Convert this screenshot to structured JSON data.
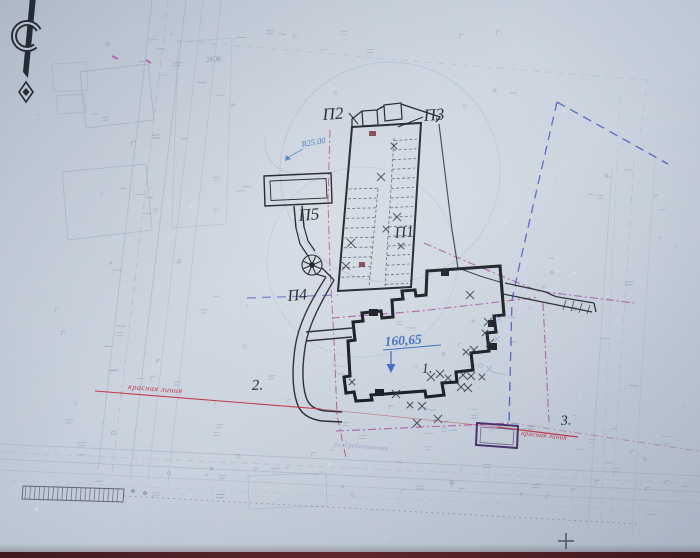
{
  "drawing": {
    "north_arrow_letter": "С",
    "labels": {
      "p1": "П1",
      "p2": "П2",
      "p3": "П3",
      "p4": "П4",
      "p5": "П5",
      "zone1": "1.",
      "zone2": "2.",
      "zone3": "3.",
      "building_note": "2КЖ"
    },
    "annotations": {
      "elevation": "160,65",
      "radius": "R25.00",
      "red_line_left": "красная линия",
      "red_line_right": "красная линия",
      "street": "ул. Гребенщикова"
    },
    "colors": {
      "paper": "#cbd4df",
      "ink": "#23262e",
      "faint_line": "#98a4ba",
      "blue_note": "#3f6fbf",
      "blue_boundary": "#4150bd",
      "red_line": "#c23a4a",
      "pink_boundary": "#b1486e",
      "magenta_boundary": "#a8489a",
      "purple_structure": "#4a3070",
      "photo_edge": "#58262b"
    }
  }
}
